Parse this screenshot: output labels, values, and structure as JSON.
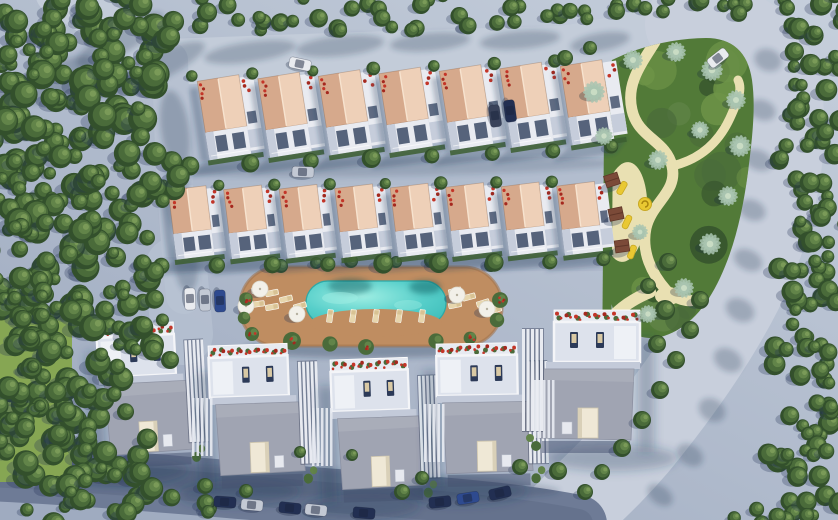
{
  "scene": {
    "description": "aerial-3d-render-residential-complex",
    "canvas": {
      "width": 838,
      "height": 520
    },
    "counts": {
      "upper_townhouses": 7,
      "middle_townhouses": 8,
      "detached_villas": 5,
      "pool": 1,
      "playground_structures": 3
    },
    "palette": {
      "baseTop": "#c6cfdc",
      "baseBottom": "#9fabc0",
      "roadLitTop": "#c3ccd9",
      "roadLitRight": "#c8cfdc",
      "roadLeft": "#b7c1d1",
      "roadBottom": "#6e7b96",
      "roadBottomCore": "#63708b",
      "softShadow": "rgba(40,56,90,0.28)",
      "deepShadow": "rgba(30,44,76,0.38)",
      "treeDark": "#33502c",
      "treeMid": "#4a6b3a",
      "treeLight": "#628449",
      "treeBright": "#7a9a58",
      "grass": "#86a653",
      "parkGreen": "#527a38",
      "parkLight": "#6e9448",
      "sand": "#e9e0b2",
      "palm": "#a9c4b0",
      "palmCore": "#c9dcc4",
      "roofLit": "#eed0b8",
      "roofShade": "#d6a98c",
      "roofRidge": "#f7e3cf",
      "facadeWhite": "#e9ebf1",
      "facadeShade": "#c6cddb",
      "windowDark": "#3c4b66",
      "flowerRed": "#a5281e",
      "flowerRed2": "#c43528",
      "hedge": "#3c5e30",
      "deck": "#bf8d61",
      "deckDark": "#a3754c",
      "waterLight": "#9feee3",
      "water": "#57cfca",
      "waterDeep": "#3cbcb8",
      "lounger": "#e7d6ad",
      "villaRoof": "#a0a4b2",
      "villaWhite": "#eef0f5",
      "terraceFloor": "#dde2ec",
      "skylight": "#efe8d6",
      "playWood": "#7b4a38",
      "playWoodDark": "#5f3628",
      "playYellow": "#e9c832",
      "playYellowDark": "#c8a822"
    },
    "roads": [
      {
        "d": "M 58,-8 L 170,62 C 300,57 430,52 562,49 C 612,42 648,30 688,24",
        "w": 46,
        "color": "roadLitTop"
      },
      {
        "d": "M 688,24 C 745,22 775,55 780,100 C 786,160 770,230 740,290 C 712,345 672,400 635,445 C 605,480 580,500 560,522",
        "w": 86,
        "color": "roadLitRight"
      },
      {
        "d": "M 170,60 C 172,140 176,220 184,296",
        "w": 36,
        "color": "roadLeft"
      },
      {
        "d": "M 176,268 L 182,334",
        "w": 62,
        "color": "roadLeft",
        "op": 0.75
      },
      {
        "d": "M -12,472 C 120,478 250,492 390,502 C 470,508 528,514 578,524",
        "w": 58,
        "color": "roadBottom"
      },
      {
        "d": "M -12,472 C 120,478 250,492 390,502 C 470,508 528,514 578,524",
        "w": 30,
        "color": "roadBottomCore",
        "op": 0.8
      }
    ],
    "overlays": [
      {
        "x": 160,
        "y": 157,
        "w": 462,
        "h": 28,
        "fill": "#aeb9cb",
        "op": 0.6
      },
      {
        "x": 162,
        "y": 257,
        "w": 450,
        "h": 14,
        "fill": "#a9b4c7",
        "op": 0.5
      }
    ],
    "road_shadows": [
      [
        150,
        70,
        60,
        14,
        -25
      ],
      [
        250,
        52,
        46,
        10,
        -8
      ],
      [
        340,
        46,
        44,
        10,
        -6
      ],
      [
        430,
        42,
        40,
        9,
        -5
      ],
      [
        520,
        40,
        40,
        9,
        -5
      ],
      [
        600,
        42,
        30,
        9,
        -10
      ],
      [
        120,
        40,
        50,
        14,
        -30
      ],
      [
        60,
        80,
        40,
        16,
        -30
      ],
      [
        175,
        130,
        14,
        40,
        -8
      ],
      [
        178,
        200,
        12,
        36,
        -5
      ],
      [
        186,
        262,
        12,
        30,
        -5
      ],
      [
        768,
        60,
        14,
        11,
        20
      ],
      [
        762,
        110,
        14,
        10,
        20
      ],
      [
        758,
        160,
        15,
        10,
        22
      ],
      [
        752,
        210,
        14,
        10,
        24
      ],
      [
        748,
        260,
        15,
        10,
        26
      ],
      [
        740,
        310,
        15,
        11,
        28
      ],
      [
        728,
        360,
        15,
        11,
        30
      ],
      [
        712,
        410,
        14,
        11,
        32
      ],
      [
        690,
        455,
        14,
        10,
        34
      ],
      [
        660,
        495,
        14,
        9,
        36
      ],
      [
        390,
        167,
        230,
        9,
        -1,
        0.45
      ],
      [
        380,
        262,
        220,
        8,
        -1,
        0.4
      ],
      [
        300,
        482,
        260,
        14,
        2,
        0.5
      ],
      [
        371,
        349,
        128,
        9,
        0,
        0.8
      ]
    ],
    "grass": {
      "x": 0,
      "y": 312,
      "w": 72,
      "h": 170
    },
    "park": {
      "blob": "M 612,60 C 640,46 676,38 706,38 C 732,38 748,52 752,80 C 756,108 752,140 748,172 C 743,210 735,246 720,278 C 706,308 688,328 664,336 C 644,342 626,334 616,316 C 608,300 606,274 605,244 C 604,196 605,144 607,104 C 608,84 609,70 612,60 Z",
      "texture_n": 26,
      "hedge": {
        "d": "M 609,72 L 607,312",
        "w": 9
      },
      "paths": [
        {
          "d": "M 655,42 C 640,66 626,84 632,110 C 638,138 666,140 672,166 C 678,192 652,202 646,228 C 641,252 652,274 666,290 C 676,300 688,302 695,300",
          "w": 11
        },
        {
          "d": "M 672,166 C 698,160 718,144 730,118 C 740,96 742,88 738,80",
          "w": 9
        }
      ],
      "clearing": [
        625,
        212,
        22,
        50,
        4
      ],
      "pocket": [
        668,
        296,
        13,
        9
      ],
      "sand_exit": {
        "d": "M 650,292 C 630,300 614,312 602,330",
        "w": 12
      }
    },
    "pool": {
      "deck": {
        "x": 240,
        "y": 267,
        "w": 262,
        "h": 79,
        "r": 38
      },
      "water": {
        "x": 306,
        "y": 281,
        "w": 140,
        "h": 44,
        "r": 22
      },
      "scallop": [
        376,
        323,
        66,
        14
      ],
      "loungers_row": {
        "x0": 330,
        "y": 316,
        "n": 5,
        "dx": 23,
        "rot": 8
      },
      "pad_loungers": [
        [
          272,
          293,
          78
        ],
        [
          272,
          307,
          80
        ],
        [
          286,
          299,
          76
        ],
        [
          300,
          306,
          74
        ],
        [
          258,
          290,
          80
        ],
        [
          258,
          304,
          82
        ],
        [
          455,
          291,
          76
        ],
        [
          455,
          305,
          78
        ],
        [
          469,
          297,
          75
        ],
        [
          483,
          303,
          73
        ],
        [
          495,
          310,
          72
        ]
      ],
      "umbrellas": [
        [
          260,
          289
        ],
        [
          297,
          314
        ],
        [
          457,
          295
        ],
        [
          487,
          309
        ],
        [
          246,
          306
        ]
      ],
      "edge_bushes": [
        [
          246,
          299,
          1
        ],
        [
          244,
          318,
          0
        ],
        [
          252,
          334,
          1
        ],
        [
          292,
          341,
          1
        ],
        [
          330,
          344,
          0
        ],
        [
          366,
          347,
          1
        ],
        [
          470,
          338,
          1
        ],
        [
          497,
          320,
          0
        ],
        [
          500,
          300,
          1
        ],
        [
          436,
          341,
          0
        ]
      ],
      "top_trees": [
        [
          281,
          266,
          7
        ],
        [
          351,
          261,
          7
        ],
        [
          431,
          261,
          7
        ],
        [
          491,
          265,
          7
        ],
        [
          316,
          263,
          6
        ],
        [
          396,
          262,
          6
        ]
      ],
      "water_shadows": [
        [
          350,
          286,
          22,
          8
        ],
        [
          425,
          287,
          16,
          7
        ]
      ]
    },
    "townhouse_rows": [
      {
        "name": "upper-townhouse-row",
        "count": 7,
        "x0": 218,
        "dx": 60.5,
        "y0": 78,
        "dy": -2.5,
        "rot": -9,
        "roof_w": 42,
        "roof_h": 52,
        "facade_h": 28,
        "strip_w": 14
      },
      {
        "name": "middle-townhouse-row",
        "count": 8,
        "x0": 187,
        "dx": 55.5,
        "y0": 188,
        "dy": -0.6,
        "rot": -7,
        "roof_w": 38,
        "roof_h": 44,
        "facade_h": 26,
        "strip_w": 12
      }
    ],
    "villas": [
      {
        "x": 96,
        "y": 326,
        "w": 90,
        "rot": -3,
        "mirror": false
      },
      {
        "x": 208,
        "y": 346,
        "w": 92,
        "rot": -2,
        "mirror": false
      },
      {
        "x": 330,
        "y": 360,
        "w": 90,
        "rot": -2,
        "mirror": false
      },
      {
        "x": 436,
        "y": 344,
        "w": 94,
        "rot": -1,
        "mirror": false
      },
      {
        "x": 540,
        "y": 310,
        "w": 100,
        "rot": 0,
        "mirror": true
      }
    ],
    "fences": [
      [
        192,
        398
      ],
      [
        312,
        408
      ],
      [
        424,
        404
      ],
      [
        534,
        380
      ]
    ],
    "tree_clusters": {
      "forest-top-left": [
        [
          55,
          38,
          62,
          55
        ],
        [
          135,
          30,
          48,
          40
        ],
        [
          38,
          118,
          58,
          52
        ],
        [
          118,
          102,
          52,
          46
        ],
        [
          55,
          192,
          58,
          52
        ],
        [
          133,
          178,
          46,
          42
        ],
        [
          40,
          267,
          55,
          50
        ],
        [
          113,
          257,
          45,
          42
        ],
        [
          60,
          327,
          48,
          42
        ],
        [
          138,
          322,
          38,
          34
        ],
        [
          16,
          305,
          40,
          38
        ]
      ],
      "tree-band-top": [
        [
          215,
          12,
          26,
          18
        ],
        [
          252,
          24,
          22,
          14
        ],
        [
          290,
          10,
          24,
          16
        ],
        [
          330,
          22,
          20,
          12
        ],
        [
          368,
          12,
          24,
          14
        ],
        [
          404,
          24,
          20,
          12
        ],
        [
          442,
          10,
          24,
          14
        ],
        [
          478,
          20,
          20,
          12
        ],
        [
          515,
          10,
          22,
          13
        ],
        [
          548,
          18,
          18,
          11
        ],
        [
          584,
          8,
          20,
          12
        ],
        [
          620,
          4,
          20,
          10
        ],
        [
          660,
          4,
          22,
          11
        ],
        [
          700,
          7,
          24,
          12
        ],
        [
          736,
          5,
          22,
          10
        ]
      ],
      "tree-band-right": [
        [
          815,
          10,
          35,
          28
        ],
        [
          812,
          60,
          32,
          30
        ],
        [
          818,
          110,
          30,
          30
        ],
        [
          810,
          160,
          32,
          32
        ],
        [
          820,
          210,
          30,
          30
        ],
        [
          808,
          260,
          32,
          32
        ],
        [
          818,
          310,
          32,
          32
        ],
        [
          806,
          360,
          34,
          34
        ],
        [
          820,
          410,
          32,
          32
        ],
        [
          804,
          455,
          36,
          34
        ],
        [
          818,
          500,
          34,
          26
        ],
        [
          760,
          516,
          28,
          16
        ]
      ],
      "forest-bottom-left": [
        [
          28,
          372,
          40,
          36
        ],
        [
          95,
          387,
          42,
          38
        ],
        [
          45,
          442,
          45,
          40
        ],
        [
          115,
          452,
          40,
          36
        ],
        [
          60,
          497,
          40,
          30
        ],
        [
          140,
          497,
          34,
          26
        ],
        [
          8,
          412,
          35,
          32
        ],
        [
          195,
          504,
          26,
          16
        ]
      ]
    },
    "single_trees": [
      [
        152,
        345,
        12
      ],
      [
        170,
        360,
        9
      ],
      [
        133,
        468,
        9
      ],
      [
        205,
        486,
        8
      ],
      [
        246,
        491,
        7
      ],
      [
        402,
        492,
        8
      ],
      [
        422,
        478,
        7
      ],
      [
        520,
        467,
        8
      ],
      [
        558,
        471,
        9
      ],
      [
        352,
        455,
        6
      ],
      [
        300,
        452,
        6
      ],
      [
        665,
        310,
        10
      ],
      [
        657,
        344,
        9
      ],
      [
        700,
        300,
        9
      ],
      [
        690,
        330,
        9
      ],
      [
        676,
        360,
        9
      ],
      [
        660,
        390,
        9
      ],
      [
        642,
        420,
        9
      ],
      [
        622,
        448,
        9
      ],
      [
        602,
        472,
        8
      ],
      [
        585,
        492,
        8
      ],
      [
        668,
        262,
        9
      ],
      [
        648,
        286,
        8
      ],
      [
        565,
        58,
        8
      ],
      [
        590,
        48,
        7
      ]
    ],
    "palms": [
      [
        594,
        92,
        11
      ],
      [
        633,
        60,
        10
      ],
      [
        676,
        52,
        10
      ],
      [
        712,
        70,
        11
      ],
      [
        736,
        100,
        10
      ],
      [
        740,
        146,
        11
      ],
      [
        728,
        196,
        10
      ],
      [
        710,
        244,
        11
      ],
      [
        684,
        288,
        10
      ],
      [
        648,
        314,
        9
      ],
      [
        604,
        136,
        9
      ],
      [
        658,
        160,
        10
      ],
      [
        700,
        130,
        9
      ],
      [
        640,
        232,
        8
      ]
    ],
    "playground": {
      "structures": [
        [
          612,
          180,
          -18
        ],
        [
          616,
          214,
          -12
        ],
        [
          622,
          246,
          -8
        ]
      ],
      "slides": [
        [
          622,
          188,
          30
        ],
        [
          627,
          222,
          25
        ],
        [
          632,
          252,
          20
        ]
      ],
      "spiral": [
        645,
        204
      ]
    },
    "cars": [
      [
        300,
        64,
        12,
        "white"
      ],
      [
        718,
        58,
        -38,
        "white"
      ],
      [
        303,
        172,
        2,
        "silver"
      ],
      [
        495,
        116,
        82,
        "dark"
      ],
      [
        510,
        111,
        82,
        "navy"
      ],
      [
        190,
        299,
        88,
        "white"
      ],
      [
        205,
        300,
        88,
        "silver"
      ],
      [
        220,
        301,
        88,
        "blue"
      ],
      [
        225,
        502,
        4,
        "navy"
      ],
      [
        252,
        505,
        5,
        "silver"
      ],
      [
        290,
        508,
        6,
        "navy"
      ],
      [
        316,
        510,
        6,
        "silver"
      ],
      [
        364,
        513,
        5,
        "navy"
      ],
      [
        440,
        502,
        -6,
        "navy"
      ],
      [
        468,
        498,
        -9,
        "blue"
      ],
      [
        500,
        493,
        -13,
        "navy"
      ]
    ],
    "car_colors": {
      "white": "#e9ebef",
      "silver": "#c3c9d4",
      "blue": "#2e4a8f",
      "navy": "#222f52",
      "dark": "#39425a"
    }
  }
}
